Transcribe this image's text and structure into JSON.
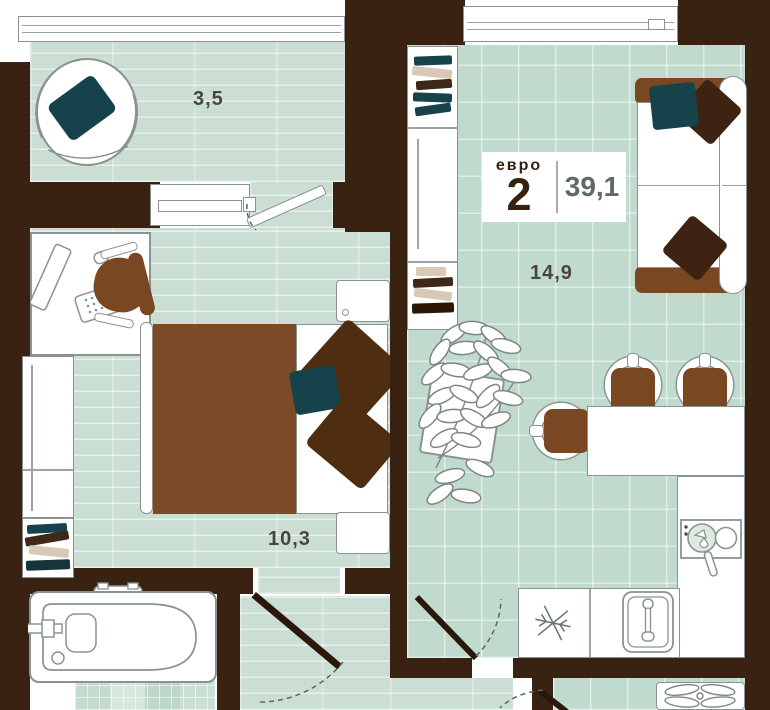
{
  "floorplan": {
    "badge": {
      "prefix": "евро",
      "rooms": "2",
      "area": "39,1"
    },
    "labels": {
      "balcony": "3,5",
      "living_kitchen": "14,9",
      "bedroom": "10,3"
    },
    "icons": [
      "armchair",
      "desk-computer",
      "office-chair",
      "wardrobe",
      "books",
      "double-bed",
      "pillows",
      "nightstand",
      "bathtub",
      "bookcase",
      "plant",
      "sofa",
      "dining-table",
      "dining-chair",
      "refrigerator-snowflake",
      "sink",
      "stove-with-pan",
      "door-leaf",
      "door-swing-arc",
      "window",
      "hallway-rack"
    ],
    "colors": {
      "wall": "#3A2212",
      "plank_floor": "#CBDED4",
      "tile_floor": "#C1DACE",
      "mosaic_floor": "#CFE2D7",
      "furniture_brown": "#7A4723",
      "pillow_teal": "#16424B",
      "pillow_brown": "#4F2D10",
      "door_leaf": "#2A180A",
      "outline": "#8A938F",
      "room_label_text": "#4A463E",
      "badge_text": "#38220F",
      "badge_area_text": "#5E6A68"
    }
  }
}
